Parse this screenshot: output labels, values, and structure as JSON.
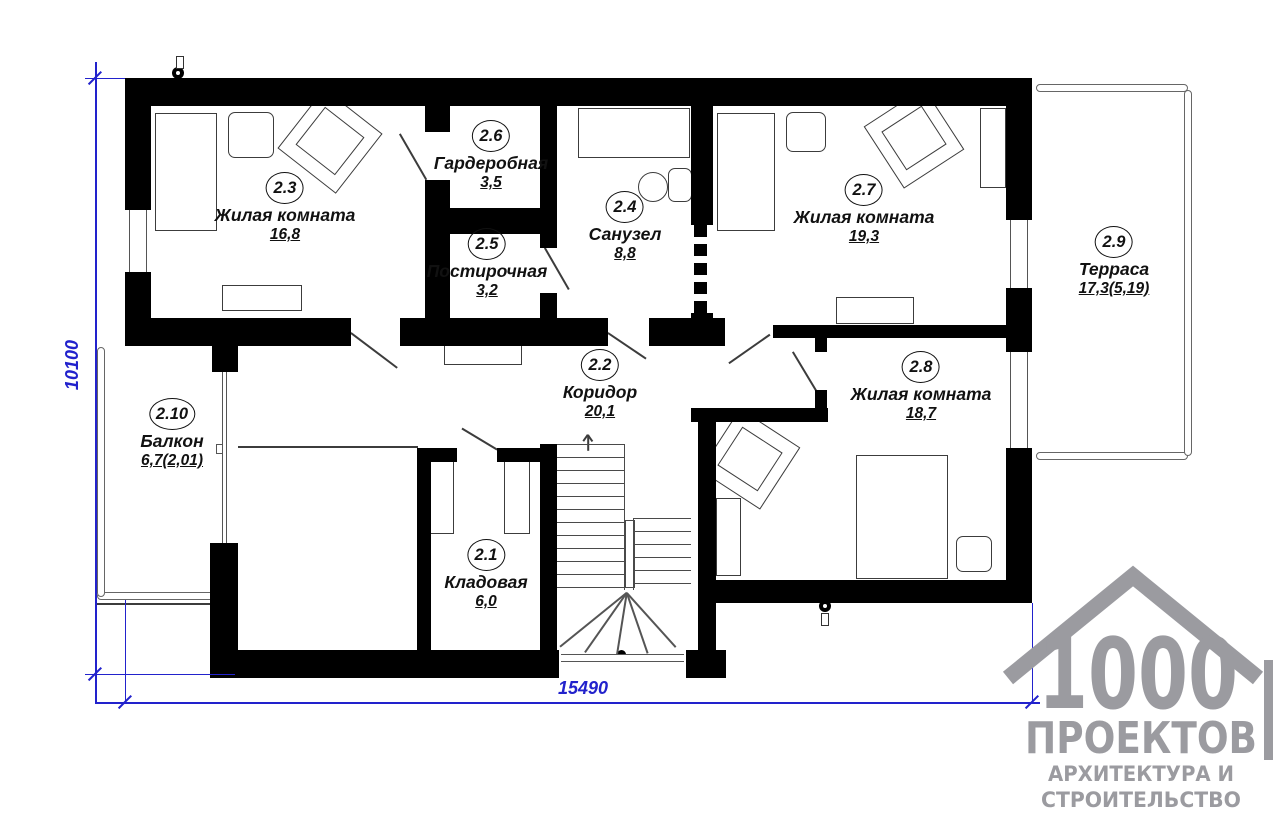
{
  "rooms": [
    {
      "num": "2.3",
      "name": "Жилая комната",
      "area": "16,8"
    },
    {
      "num": "2.6",
      "name": "Гардеробная",
      "area": "3,5"
    },
    {
      "num": "2.5",
      "name": "Постирочная",
      "area": "3,2"
    },
    {
      "num": "2.4",
      "name": "Санузел",
      "area": "8,8"
    },
    {
      "num": "2.7",
      "name": "Жилая комната",
      "area": "19,3"
    },
    {
      "num": "2.9",
      "name": "Терраса",
      "area": "17,3(5,19)"
    },
    {
      "num": "2.2",
      "name": "Коридор",
      "area": "20,1"
    },
    {
      "num": "2.8",
      "name": "Жилая комната",
      "area": "18,7"
    },
    {
      "num": "2.10",
      "name": "Балкон",
      "area": "6,7(2,01)"
    },
    {
      "num": "2.1",
      "name": "Кладовая",
      "area": "6,0"
    }
  ],
  "dimensions": {
    "bottom": "15490",
    "left": "10100"
  },
  "colors": {
    "dimension_blue": "#2222cc",
    "wall_black": "#000000",
    "logo_gray": "#9b9ba0"
  },
  "logo": {
    "digits": "1000",
    "title": "ПРОЕКТОВ",
    "subtitle1": "АРХИТЕКТУРА И",
    "subtitle2": "СТРОИТЕЛЬСТВО"
  }
}
